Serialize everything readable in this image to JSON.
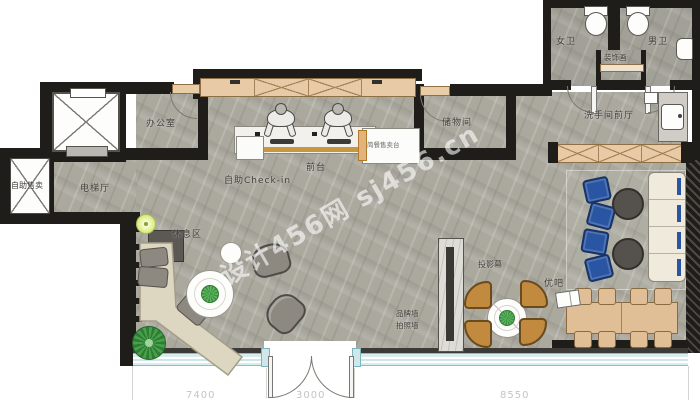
{
  "watermark": "设计456网 sj456.cn",
  "rooms": {
    "office": "办公室",
    "elevator_hall": "电梯厅",
    "vending": "自助售卖",
    "reception": "前台",
    "self_checkin": "自助Check-in",
    "snack_counter": "简餐售卖台",
    "storage": "储物间",
    "womens_wc": "女卫",
    "mens_wc": "男卫",
    "deco_painting": "装饰画",
    "restroom_hall": "洗手间前厅",
    "rest_area": "休息区",
    "bar": "优吧",
    "projection_screen": "投影幕",
    "brand_wall": "品牌墙",
    "photo_wall": "拍照墙"
  },
  "dims": {
    "left": "7400",
    "middle": "3000",
    "right": "8550"
  },
  "colors": {
    "wall": "#1f1d1a",
    "floor": "#abaaa0",
    "casework": "#e8cba6",
    "wood": "#e0bf96",
    "accent_blue": "#2a55a2",
    "chair_brown": "#c18a3e",
    "window_glass": "#d7ecee",
    "sofa_cream": "#efeadb",
    "gold_trim": "#c8963e"
  }
}
